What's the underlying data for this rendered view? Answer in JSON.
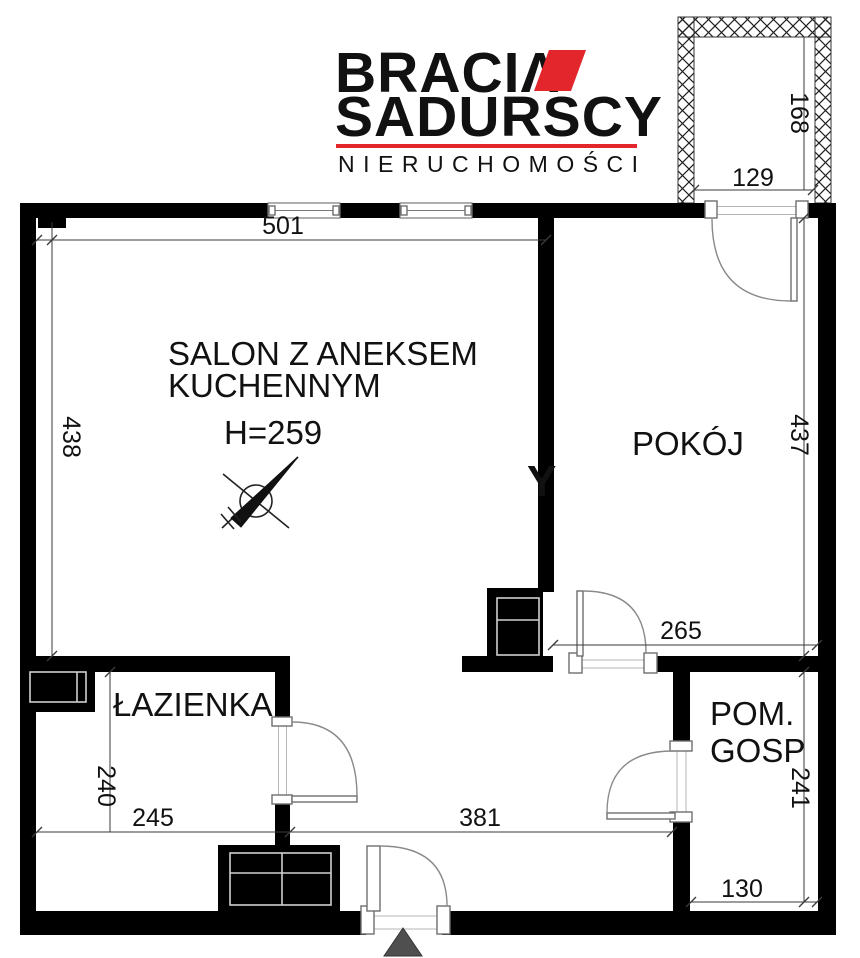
{
  "logo": {
    "brand_top": "BRACIΛ",
    "brand_bottom": "SADURSCY",
    "tagline": "NIERUCHOMOŚCI",
    "accent_color": "#e2262c",
    "text_color": "#221e1f"
  },
  "rooms": {
    "salon_line1": "SALON Z ANEKSEM",
    "salon_line2": "KUCHENNYM",
    "salon_height_note": "H=259",
    "pokoj": "POKÓJ",
    "lazienka": "ŁAZIENKA",
    "pom_gosp_line1": "POM.",
    "pom_gosp_line2": "GOSP"
  },
  "dimensions": {
    "salon_width": "501",
    "salon_depth": "438",
    "pokoj_depth": "437",
    "pokoj_width": "265",
    "lazienka_depth": "240",
    "lazienka_width": "245",
    "hall_width": "381",
    "pom_gosp_depth": "241",
    "pom_gosp_width": "130",
    "balcony_width": "129",
    "balcony_depth": "168"
  },
  "watermark": "Y",
  "colors": {
    "wall": "#000000",
    "entrance_marker": "#4f4f4f"
  }
}
